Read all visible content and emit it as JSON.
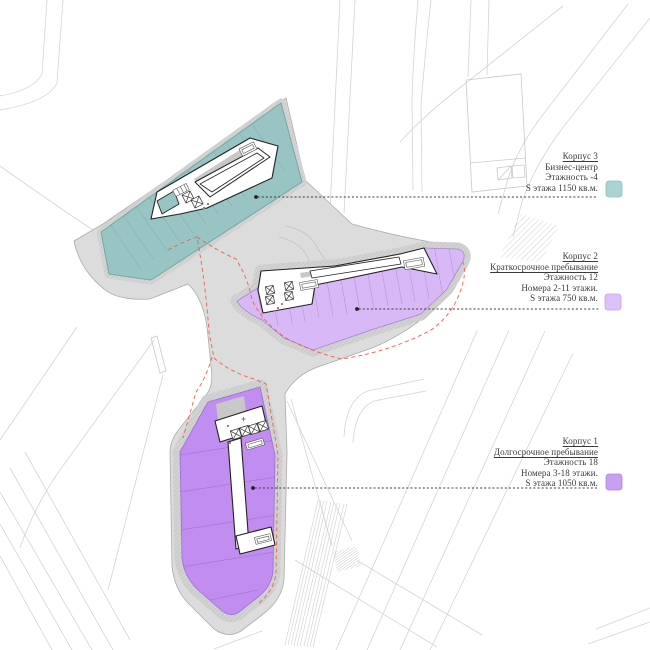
{
  "colors": {
    "korpus3_fill": "#98c4c3",
    "korpus3_swatch": "#abd3d1",
    "korpus2_fill": "#d9b8f7",
    "korpus2_swatch": "#dcc2f9",
    "korpus1_fill": "#c28df1",
    "korpus1_swatch": "#c99ff4",
    "podium_gray": "#dcdcdc",
    "site_boundary_red": "#f0604e",
    "leader_black": "#3c3c3c",
    "text": "#3a3a3a"
  },
  "legend": {
    "items": [
      {
        "id": "korpus3",
        "title": "Корпус 3",
        "subtitle": "Бизнес-центр",
        "floors": "Этажность -4",
        "area": "S этажа 1150 кв.м."
      },
      {
        "id": "korpus2",
        "title": "Корпус 2",
        "subtitle": "Краткосрочное пребывание",
        "floors": "Этажность 12",
        "rooms": "Номера 2-11 этажи.",
        "area": "S этажа 750 кв.м."
      },
      {
        "id": "korpus1",
        "title": "Корпус 1",
        "subtitle": "Долгосрочное пребывание",
        "floors": "Этажность 18",
        "rooms": "Номера 3-18 этажи.",
        "area": "S этажа 1050 кв.м."
      }
    ]
  }
}
